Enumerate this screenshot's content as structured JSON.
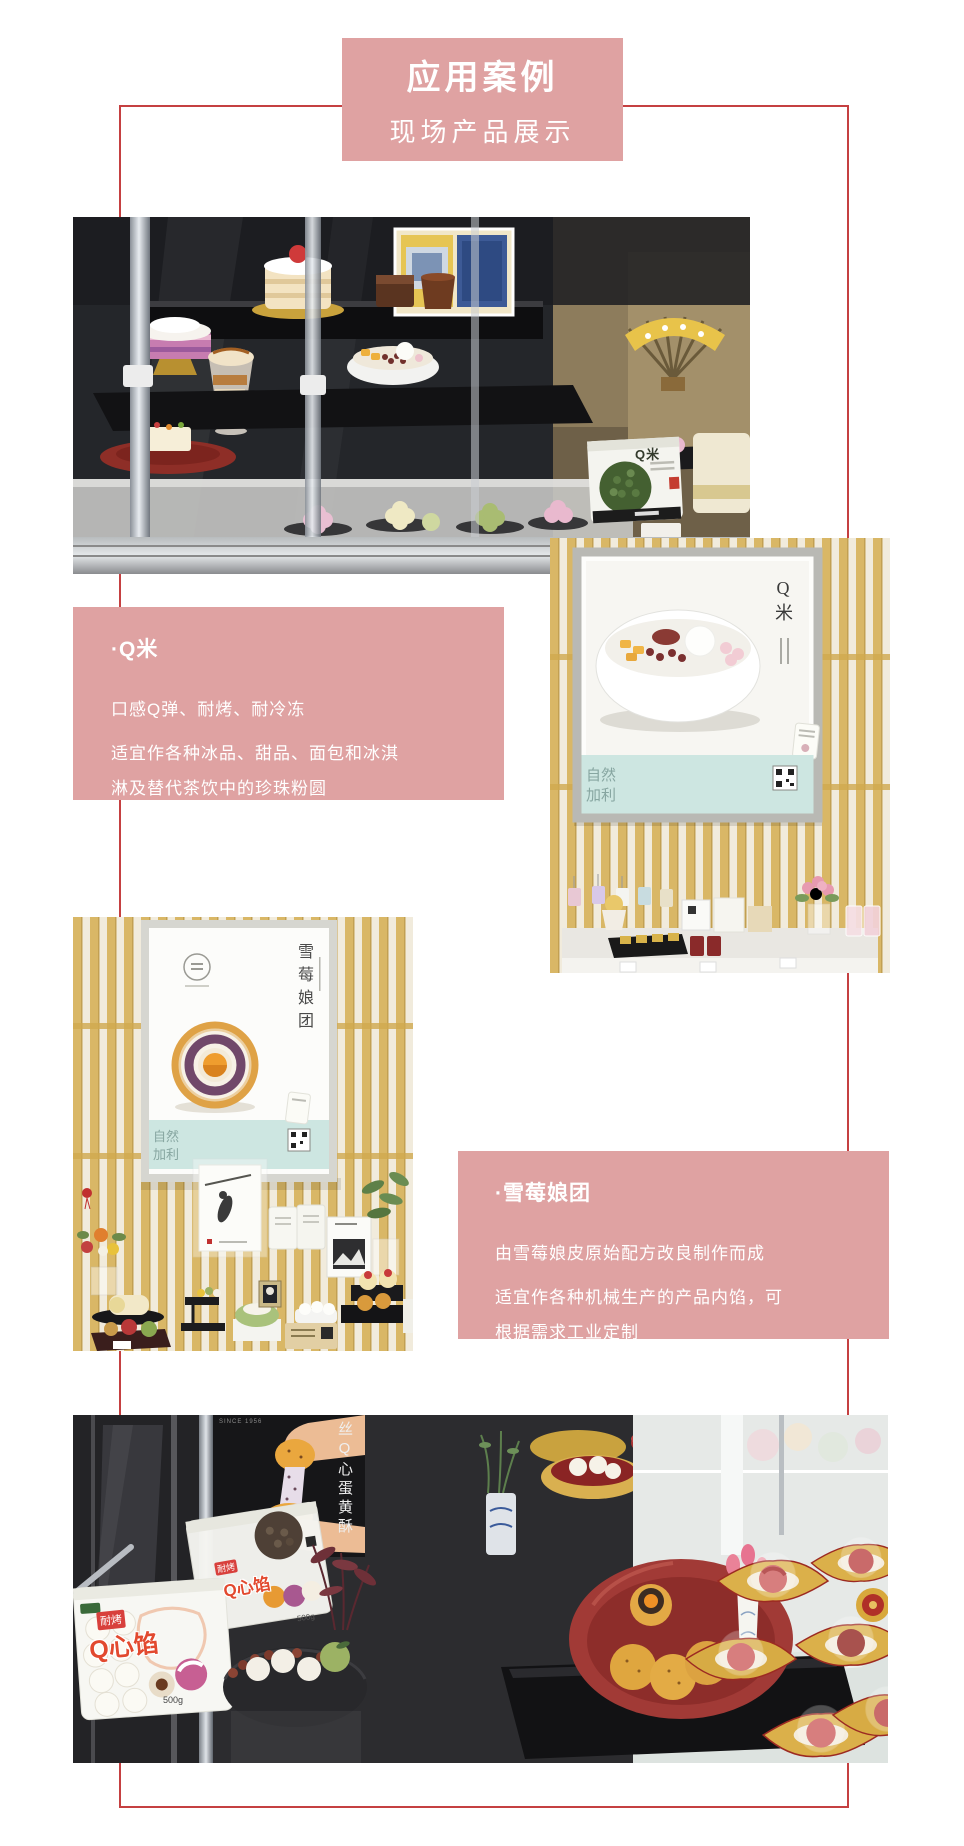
{
  "header": {
    "title": "应用案例",
    "subtitle": "现场产品展示"
  },
  "colors": {
    "accent_pink": "#dfa2a2",
    "frame_red": "#c54041",
    "poster_teal": "#cde6e1"
  },
  "products": [
    {
      "title": "·Q米",
      "lines": [
        "口感Q弹、耐烤、耐冷冻",
        "适宜作各种冰品、甜品、面包和冰淇",
        "淋及替代茶饮中的珍珠粉圆"
      ]
    },
    {
      "title": "·雪莓娘团",
      "lines": [
        "由雪莓娘皮原始配方改良制作而成",
        "适宜作各种机械生产的产品内馅，可",
        "根据需求工业定制"
      ]
    }
  ],
  "photo1": {
    "package_label": "Q米"
  },
  "photo2": {
    "poster_title": "Q米",
    "brand_line1": "自然",
    "brand_line2": "加利"
  },
  "photo3": {
    "poster_title": "雪莓娘团",
    "brand_line1": "自然",
    "brand_line2": "加利"
  },
  "photo4": {
    "sign_vertical": "丝Q心蛋黄酥",
    "since": "SINCE 1956",
    "pack_tag": "耐烤",
    "pack_name": "Q心馅",
    "pack_weight": "500g"
  }
}
